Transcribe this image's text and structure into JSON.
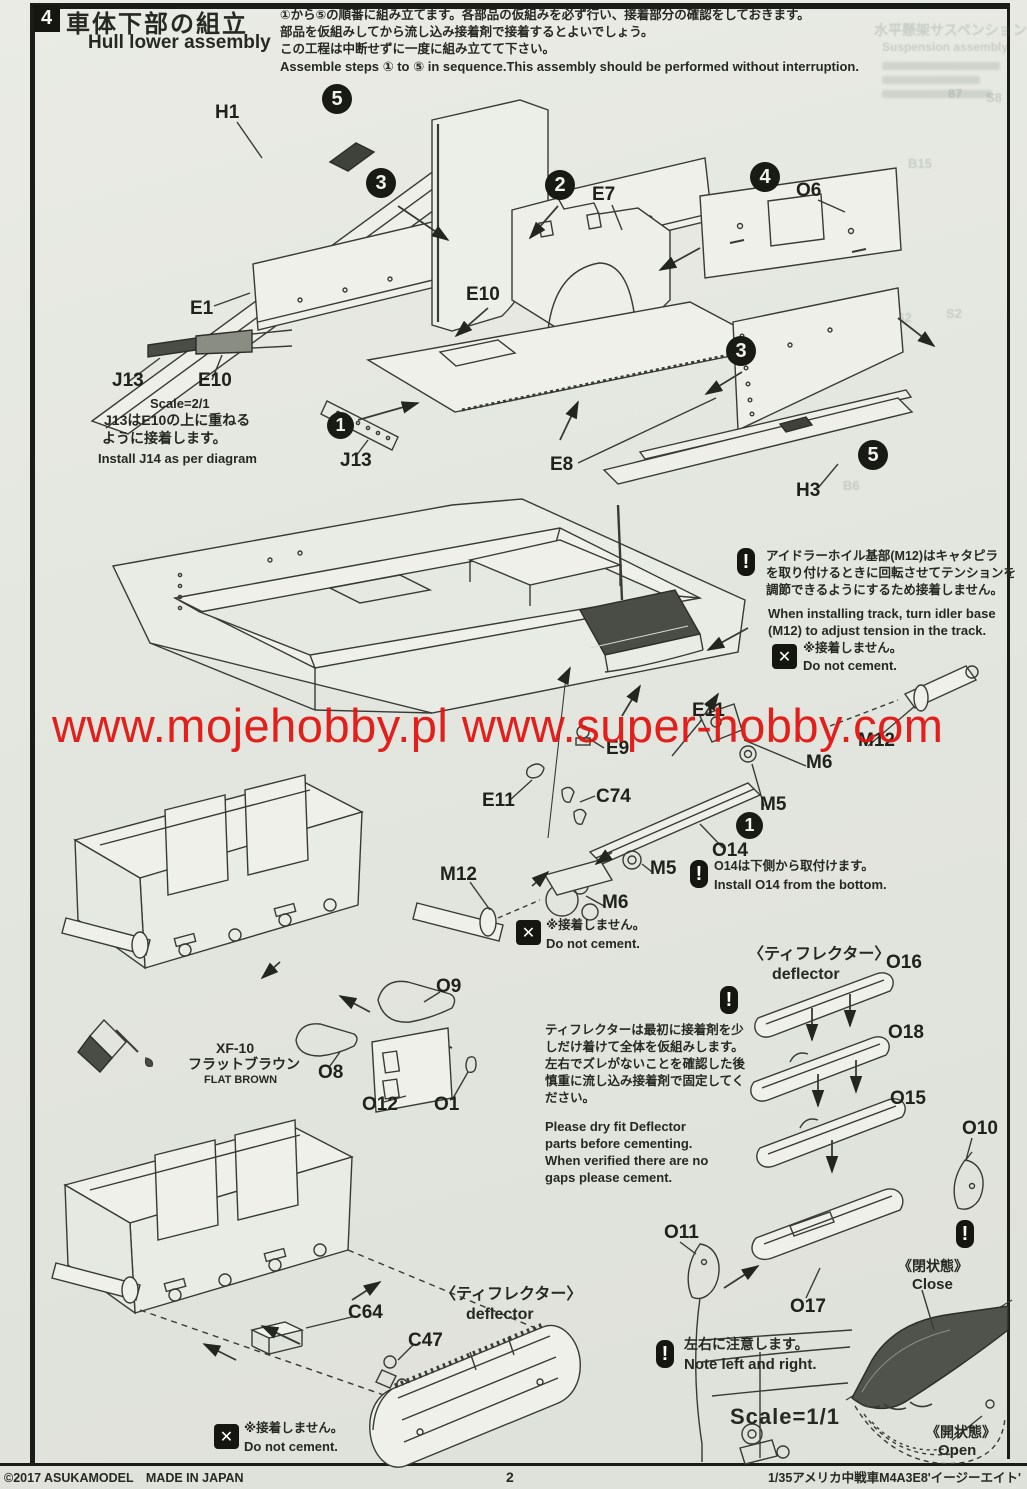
{
  "page": {
    "watermark": "www.mojehobby.pl www.super-hobby.com",
    "watermark_color": "#e21511",
    "footer": {
      "left": "©2017 ASUKAMODEL　MADE IN JAPAN",
      "center": "2",
      "right": "1/35アメリカ中戦車M4A3E8'イージーエイト'"
    }
  },
  "header": {
    "section_number": "4",
    "title_jp": "車体下部の組立",
    "title_en": "Hull lower assembly",
    "intro_jp_1": "①から⑤の順番に組み立てます。各部品の仮組みを必ず行い、接着部分の確認をしておきます。",
    "intro_jp_2": "部品を仮組みしてから流し込み接着剤で接着するとよいでしょう。",
    "intro_jp_3": "この工程は中断せずに一度に組み立てて下さい。",
    "intro_en": "Assemble steps ① to ⑤ in sequence.This assembly should be performed without interruption."
  },
  "steps": {
    "one": "1",
    "two": "2",
    "three": "3",
    "four": "4",
    "five": "5"
  },
  "parts": {
    "h1": "H1",
    "e1": "E1",
    "e7": "E7",
    "e8": "E8",
    "e9": "E9",
    "e10": "E10",
    "e11": "E11",
    "h3": "H3",
    "j13": "J13",
    "c47": "C47",
    "c64": "C64",
    "c74": "C74",
    "m5": "M5",
    "m6": "M6",
    "m12": "M12",
    "o1": "O1",
    "o6": "O6",
    "o8": "O8",
    "o9": "O9",
    "o10": "O10",
    "o11": "O11",
    "o12": "O12",
    "o14": "O14",
    "o15": "O15",
    "o16": "O16",
    "o17": "O17",
    "o18": "O18"
  },
  "notes": {
    "exclaim": "!",
    "cross": "✕",
    "j13_scale": "Scale=2/1",
    "j13_jp_1": "J13はE10の上に重ねる",
    "j13_jp_2": "ように接着します。",
    "j13_en": "Install J14 as per diagram",
    "idler_jp_1": "アイドラーホイル基部(M12)はキャタピラ",
    "idler_jp_2": "を取り付けるときに回転させてテンションを",
    "idler_jp_3": "調節できるようにするため接着しません。",
    "idler_en_1": "When installing track, turn idler base",
    "idler_en_2": "(M12) to adjust tension in the track.",
    "dnc_jp": "※接着しません。",
    "dnc_en": "Do not cement.",
    "o14_jp": "O14は下側から取付けます。",
    "o14_en": "Install O14 from the bottom.",
    "deflector_title_jp": "〈ティフレクター〉",
    "deflector_title_en": "deflector",
    "deflector_jp_1": "ティフレクターは最初に接着剤を少",
    "deflector_jp_2": "しだけ着けて全体を仮組みします。",
    "deflector_jp_3": "左右でズレがないことを確認した後",
    "deflector_jp_4": "慎重に流し込み接着剤で固定してく",
    "deflector_jp_5": "ださい。",
    "deflector_en_1": "Please dry fit Deflector",
    "deflector_en_2": "parts before cementing.",
    "deflector_en_3": "When verified there are no",
    "deflector_en_4": "gaps please cement.",
    "lr_jp": "左右に注意します。",
    "lr_en": "Note left and right.",
    "close_jp": "《閉状態》",
    "close_en": "Close",
    "open_jp": "《開状態》",
    "open_en": "Open",
    "scale_11": "Scale=1/1"
  },
  "paint": {
    "code": "XF-10",
    "name_jp": "フラットブラウン",
    "name_en": "FLAT BROWN"
  },
  "ghost": {
    "title_jp": "水平懸架サスペンション",
    "title_en": "Suspension assembly",
    "l1": "B15",
    "l2": "87",
    "l3": "S8",
    "l4": "462",
    "l5": "S2",
    "l6": "B6"
  }
}
